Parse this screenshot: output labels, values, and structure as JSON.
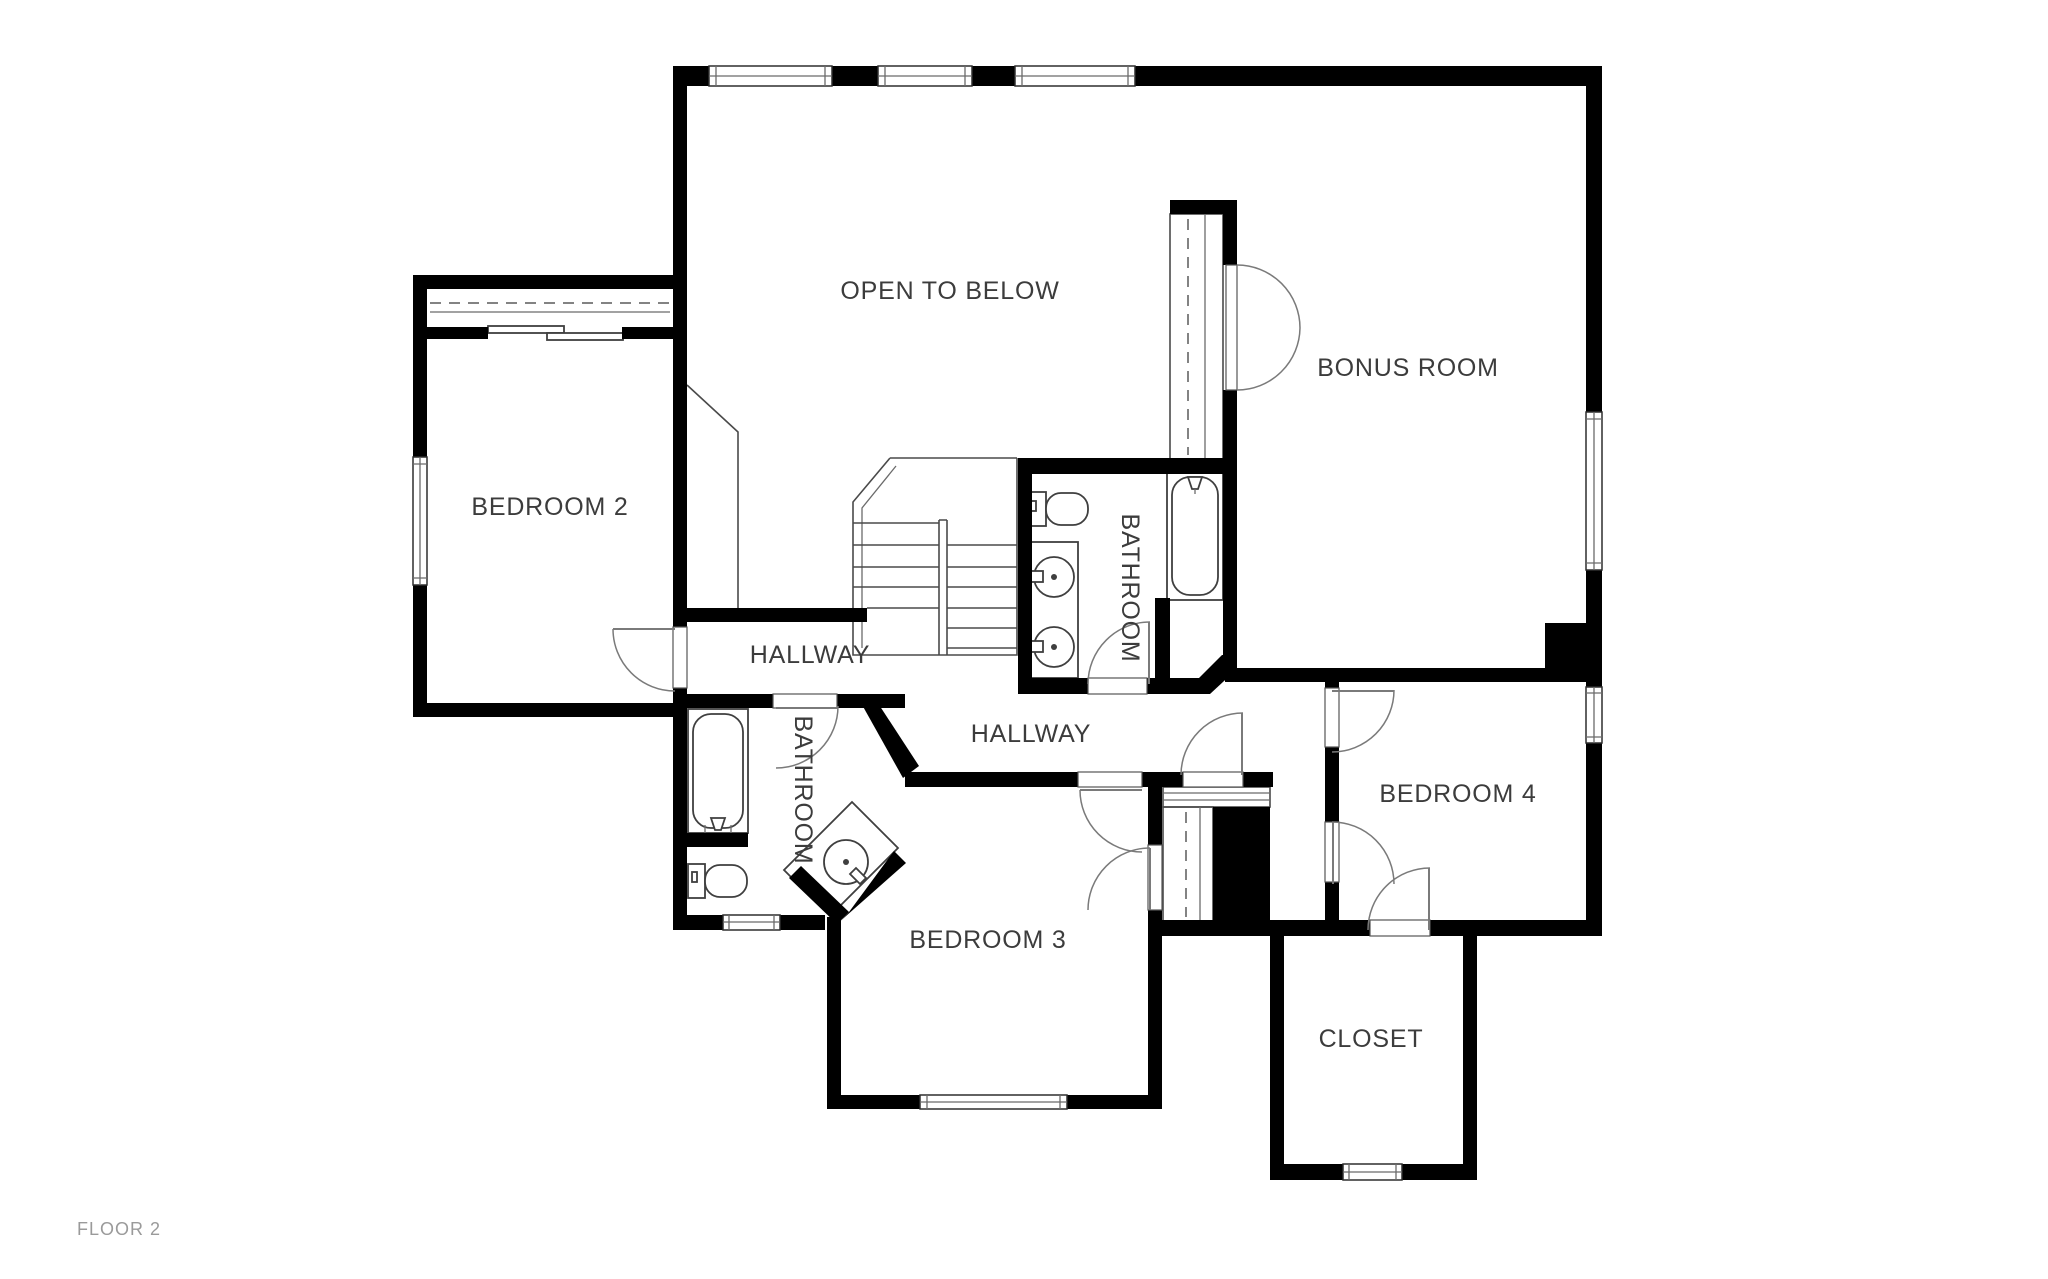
{
  "floor_plan": {
    "title": "FLOOR 2",
    "rooms": [
      {
        "id": "open-to-below",
        "label": "OPEN TO BELOW"
      },
      {
        "id": "bonus-room",
        "label": "BONUS ROOM"
      },
      {
        "id": "bedroom-2",
        "label": "BEDROOM 2"
      },
      {
        "id": "bathroom-upper",
        "label": "BATHROOM"
      },
      {
        "id": "hallway-upper",
        "label": "HALLWAY"
      },
      {
        "id": "hallway-lower",
        "label": "HALLWAY"
      },
      {
        "id": "bathroom-lower",
        "label": "BATHROOM"
      },
      {
        "id": "bedroom-3",
        "label": "BEDROOM 3"
      },
      {
        "id": "bedroom-4",
        "label": "BEDROOM 4"
      },
      {
        "id": "closet",
        "label": "CLOSET"
      }
    ],
    "colors": {
      "background": "#ffffff",
      "walls": "#000000",
      "room_label": "#3c3c3c",
      "floor_label": "#9a9a9a",
      "thin_line": "#4a4a4a"
    }
  }
}
